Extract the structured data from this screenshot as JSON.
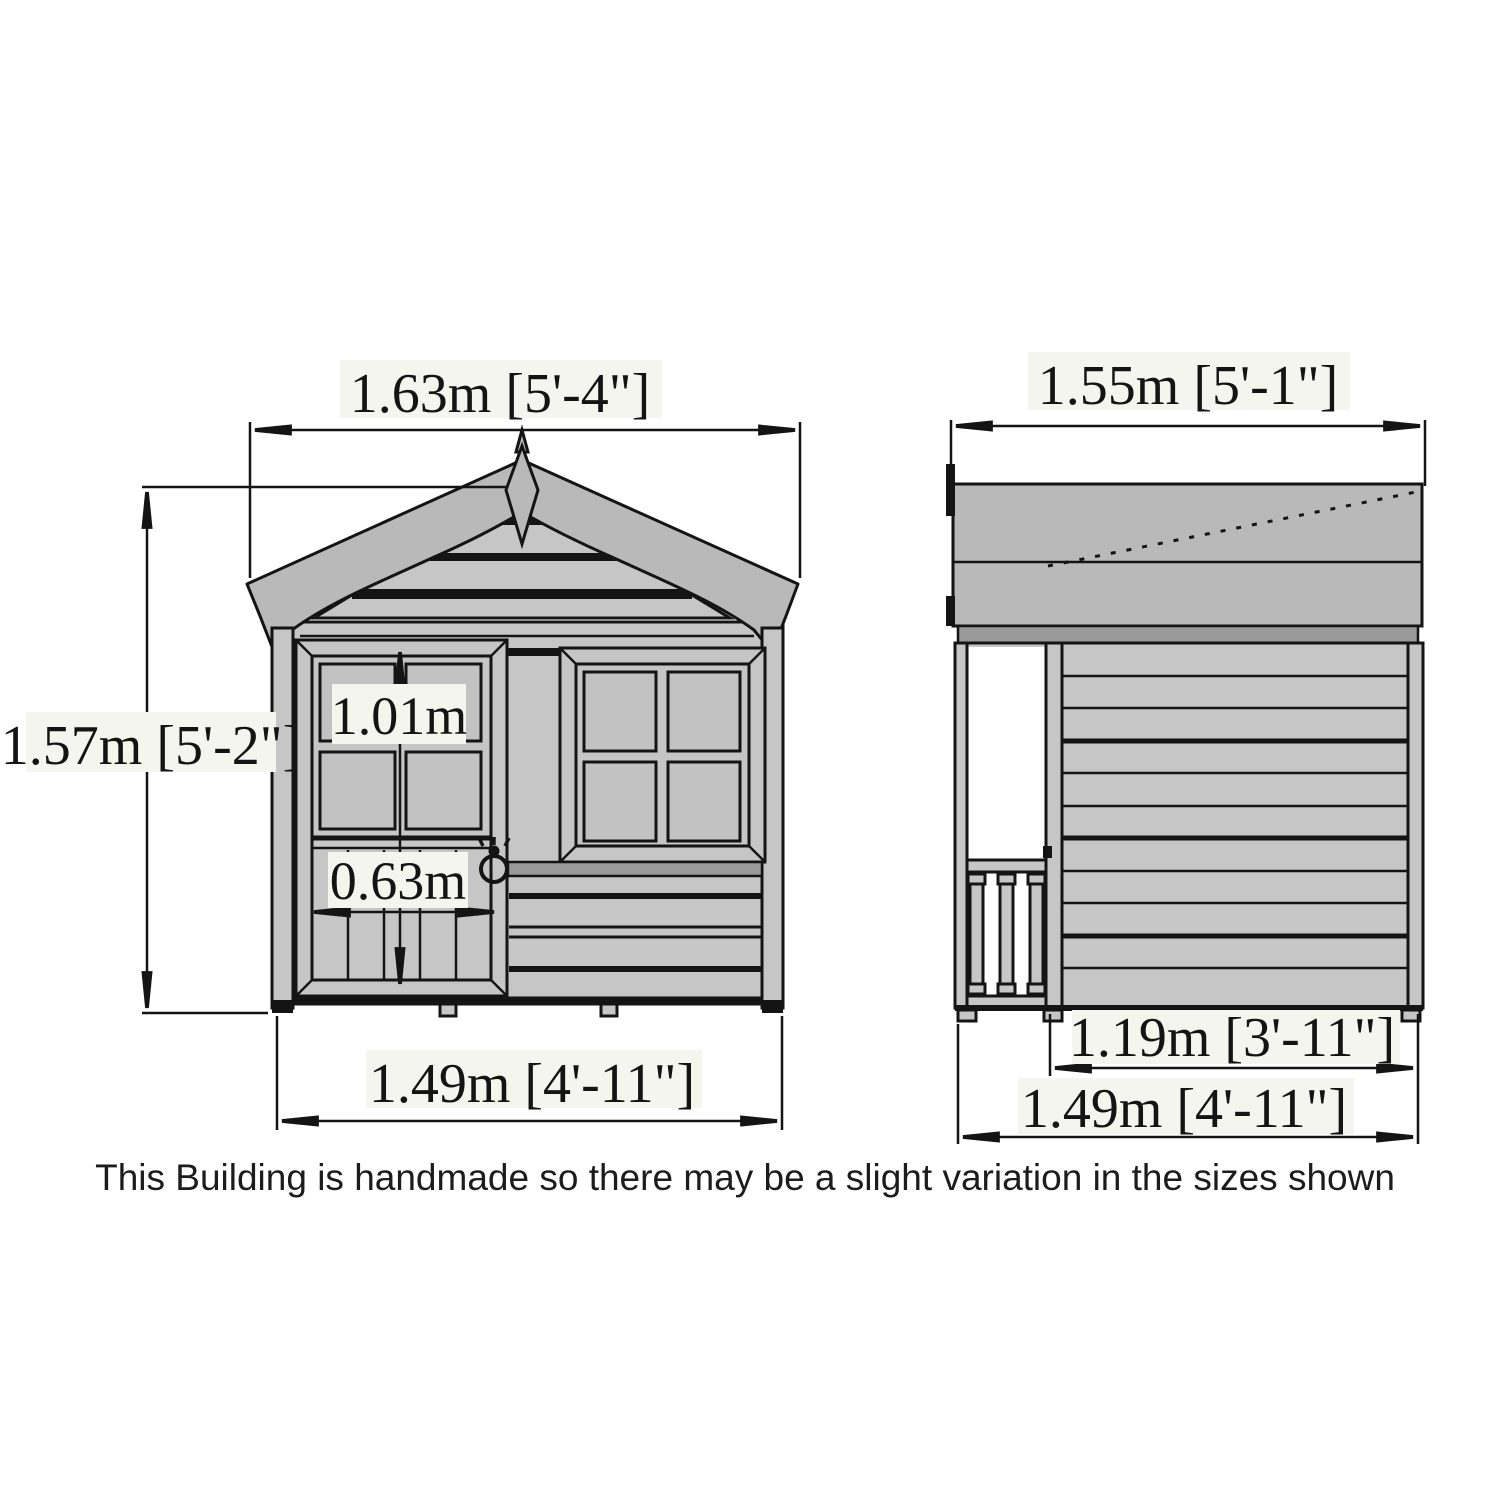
{
  "note": "This Building is handmade so there may be a slight variation in the sizes shown",
  "front_view": {
    "dim_overall_width": "1.63m [5'-4\"]",
    "dim_overall_height": "1.57m [5'-2\"]",
    "dim_door_height": "1.01m",
    "dim_door_width": "0.63m",
    "dim_base_width": "1.49m [4'-11\"]"
  },
  "side_view": {
    "dim_roof_depth": "1.55m [5'-1\"]",
    "dim_wall_depth": "1.19m [3'-11\"]",
    "dim_base_depth": "1.49m [4'-11\"]"
  },
  "colors": {
    "line": "#141414",
    "wall_fill": "#c6c6c6",
    "roof_fill": "#b9b9b9",
    "shadow_fill": "#9a9a9a",
    "label_background": "#f5f5f0",
    "background": "#ffffff"
  }
}
